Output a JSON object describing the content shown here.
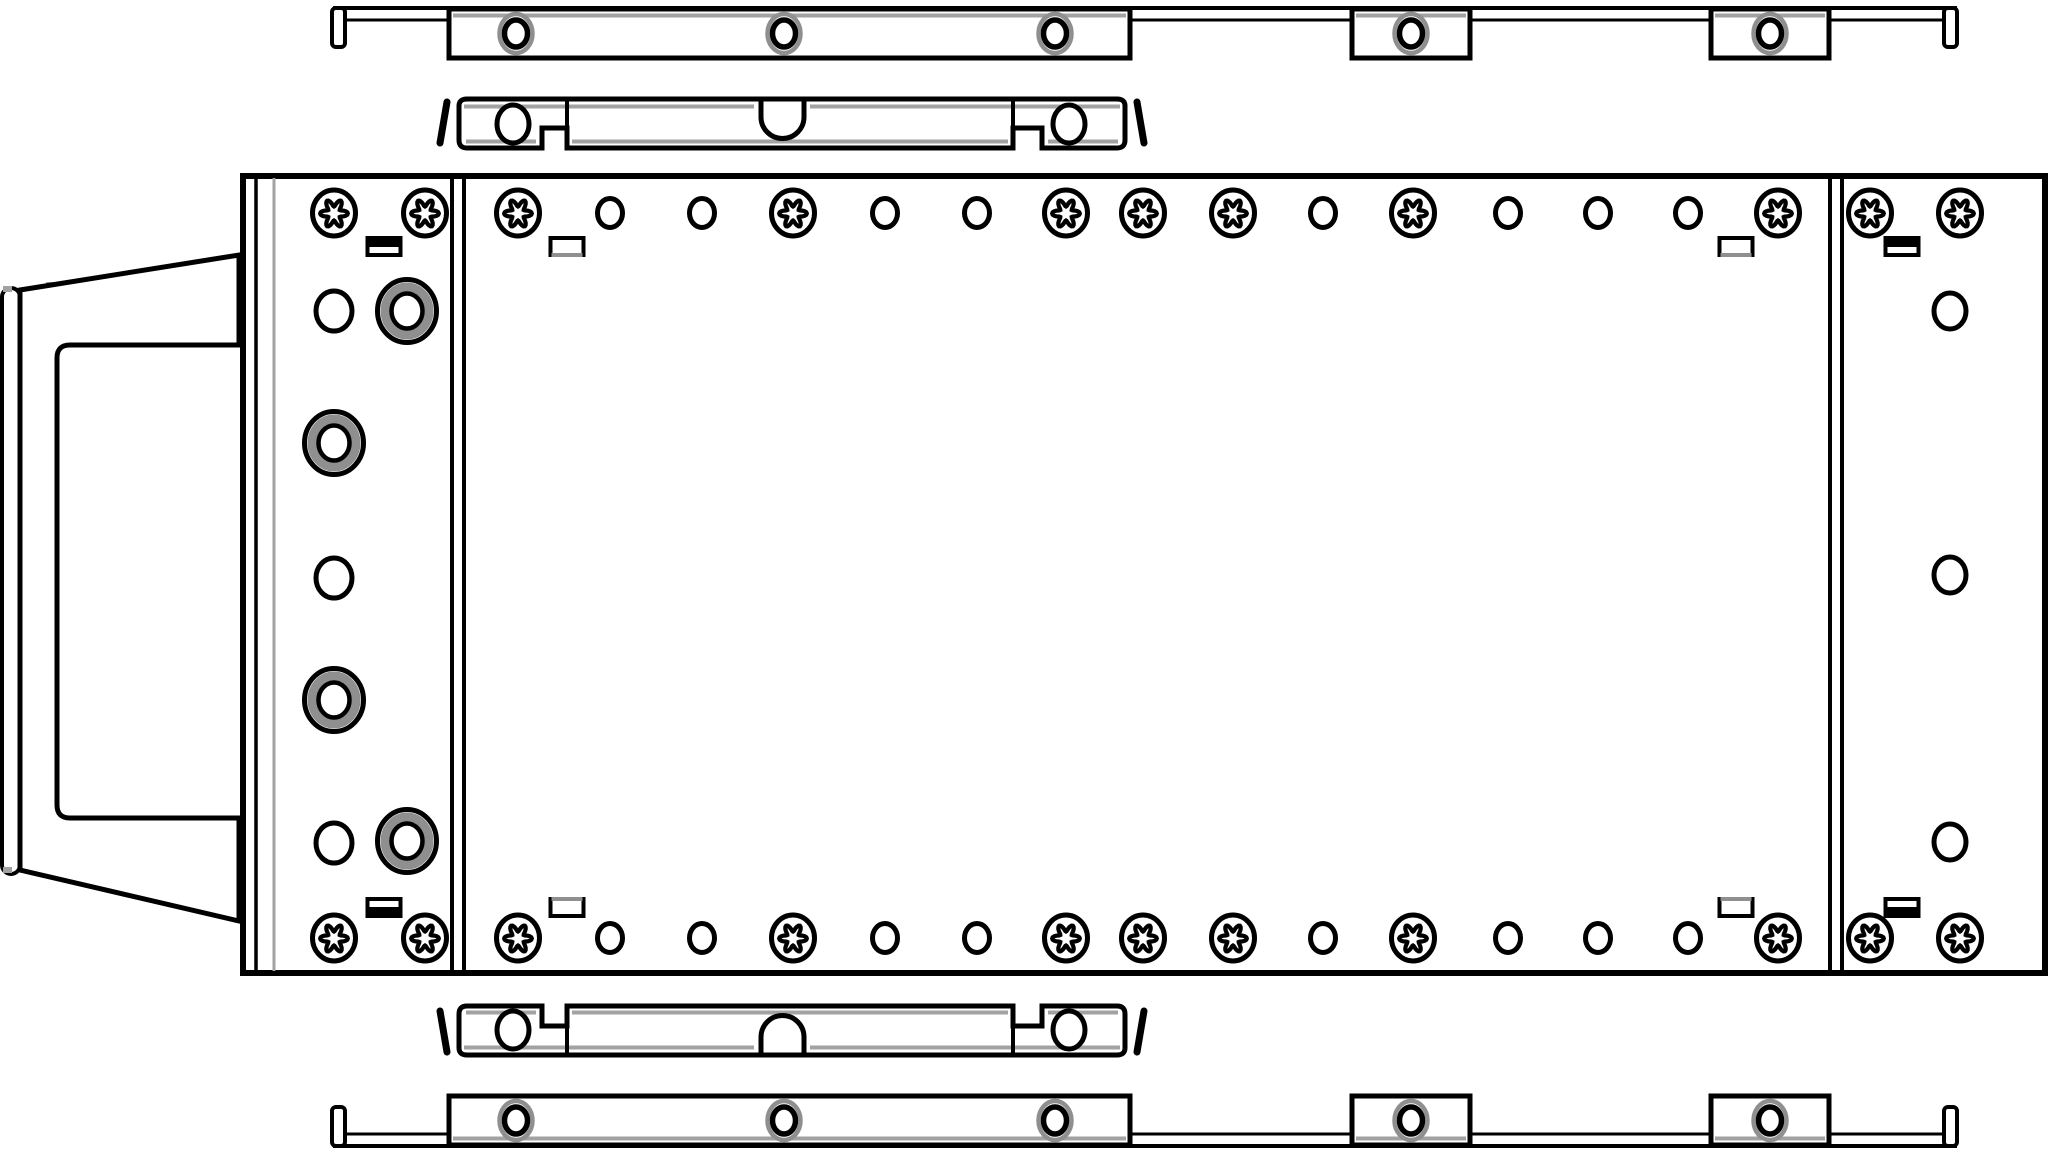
{
  "canvas": {
    "width": 2048,
    "height": 1154,
    "background": "#ffffff"
  },
  "colors": {
    "ink": "#000000",
    "ring_grey": "#8f8f8f",
    "line_grey": "#a2a2a2",
    "fill": "#ffffff"
  },
  "diagram": {
    "chassis": {
      "x": 243,
      "y": 176,
      "w": 1802,
      "h": 797,
      "inner_black_line_x": 256,
      "inner_grey_line_x": 274,
      "dividers": [
        [
          452,
          464
        ],
        [
          1830,
          1842
        ]
      ]
    },
    "fastener_rows": {
      "y": [
        213,
        938
      ],
      "items": [
        [
          334,
          "torx"
        ],
        [
          425,
          "torx"
        ],
        [
          518,
          "torx"
        ],
        [
          610,
          "hole"
        ],
        [
          702,
          "hole"
        ],
        [
          793,
          "torx"
        ],
        [
          885,
          "hole"
        ],
        [
          977,
          "hole"
        ],
        [
          1066,
          "torx"
        ],
        [
          1143,
          "torx"
        ],
        [
          1233,
          "torx"
        ],
        [
          1323,
          "hole"
        ],
        [
          1413,
          "torx"
        ],
        [
          1508,
          "hole"
        ],
        [
          1598,
          "hole"
        ],
        [
          1688,
          "hole"
        ],
        [
          1778,
          "torx"
        ],
        [
          1870,
          "torx"
        ],
        [
          1960,
          "torx"
        ]
      ]
    },
    "left_column_circles": [
      {
        "x": 334,
        "y": 311,
        "t": "hole"
      },
      {
        "x": 407,
        "y": 311,
        "t": "grommet"
      },
      {
        "x": 334,
        "y": 443,
        "t": "grommet"
      },
      {
        "x": 334,
        "y": 578,
        "t": "hole"
      },
      {
        "x": 334,
        "y": 700,
        "t": "grommet"
      },
      {
        "x": 334,
        "y": 843,
        "t": "hole"
      },
      {
        "x": 407,
        "y": 841,
        "t": "grommet"
      }
    ],
    "right_column_holes": [
      [
        1950,
        311
      ],
      [
        1950,
        575
      ],
      [
        1950,
        842
      ]
    ],
    "slots": {
      "w": 33,
      "h": 17,
      "y_top": 238,
      "y_bottom": 899,
      "items": [
        {
          "cx": 384,
          "style": "half"
        },
        {
          "cx": 567,
          "style": "grey"
        },
        {
          "cx": 1736,
          "style": "grey"
        },
        {
          "cx": 1902,
          "style": "half"
        }
      ]
    },
    "rail": {
      "plate_x": [
        333,
        1957
      ],
      "plate_top_y": 8,
      "plate_bottom_y": 20,
      "gaps": [
        [
          345,
          449
        ],
        [
          1130,
          1352
        ],
        [
          1470,
          1711
        ],
        [
          1829,
          1944
        ]
      ],
      "bar": [
        449,
        1130
      ],
      "bar_y1": 9,
      "bar_y2": 58,
      "tabs": [
        [
          1352,
          1470
        ],
        [
          1711,
          1829
        ]
      ],
      "grey_line_y": 15.5,
      "holes_x": [
        516,
        784,
        1055,
        1411,
        1770
      ],
      "hole_cy": 33.5,
      "hooks_x": [
        332,
        1944
      ],
      "hook_w": 13,
      "hook_y": 8,
      "hook_h": 39
    },
    "bracket": {
      "outline": "M459,106 Q459,99 467,99 L1117,99 Q1125,99 1125,106 L1125,140 Q1125,148 1117,148 L1042,148 L1042,128 L1013,128 L1013,148 L567,148 L567,128 L542,128 L542,148 L467,148 Q459,148 459,140 Z",
      "joints": [
        567,
        1013
      ],
      "u_notch": "M761,97 L761,117 A21.5,21.5 0 0 0 804,117 L804,97",
      "top_patch": [
        745,
        815,
        99
      ],
      "grey_top_y": 106.5,
      "grey_top": [
        [
          464,
          754
        ],
        [
          810,
          1120
        ]
      ],
      "grey_bot_y": 141.5,
      "grey_bot": [
        [
          466,
          536
        ],
        [
          572,
          1008
        ],
        [
          1048,
          1118
        ]
      ],
      "holes": [
        [
          513,
          124
        ],
        [
          1069,
          124
        ]
      ],
      "springs": [
        [
          447,
          102,
          440,
          143
        ],
        [
          1137,
          102,
          1144,
          143
        ]
      ]
    },
    "bezel": {
      "strip": {
        "x": 2,
        "y": 288,
        "w": 18,
        "h": 586,
        "rx": 9
      },
      "face": "M20,290 L239,255 L239,921 L20,870 Z",
      "pocket": "M246,345 L70,345 Q57,345 57,358 L57,805 Q57,818 70,818 L246,818",
      "grey_ticks": [
        [
          3,
          286,
          9,
          6
        ],
        [
          3,
          867,
          9,
          6
        ],
        [
          46,
          282,
          10,
          5
        ],
        [
          46,
          872,
          10,
          5
        ]
      ]
    }
  }
}
